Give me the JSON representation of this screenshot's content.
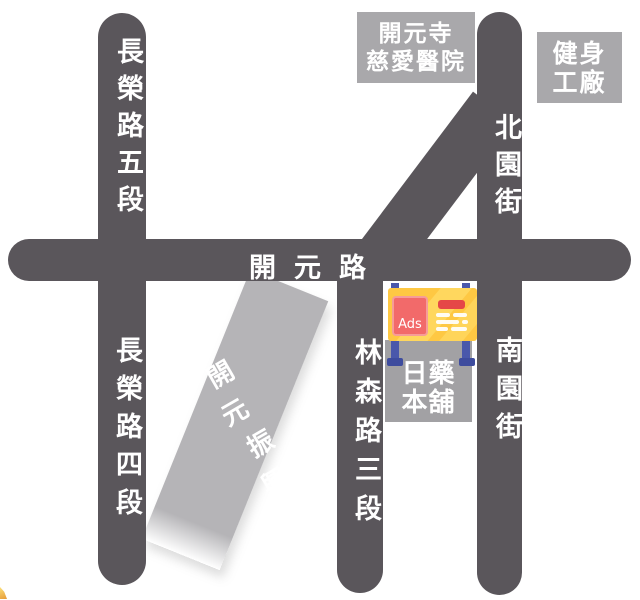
{
  "roads": {
    "changrong_5": "長榮路五段",
    "changrong_4": "長榮路四段",
    "kaiyuan": "開元路",
    "linsen_3": "林森路三段",
    "beiyuan": "北園街",
    "nanyuan": "南園街"
  },
  "park": {
    "line1": "開元",
    "line2": "振興",
    "line3": "公園"
  },
  "places": {
    "hospital": {
      "line1": "開元寺",
      "line2": "慈愛醫院"
    },
    "gym": {
      "line1": "健身",
      "line2": "工廠"
    },
    "drugstore": {
      "line1": "日藥",
      "line2": "本舖"
    }
  },
  "billboard": {
    "label": "Ads"
  },
  "colors": {
    "road": "#5a565b",
    "park": "#b5b4b7",
    "box_gray": "#a9a8ab",
    "box_gray2": "#a2a1a4",
    "sign_yellow": "#fec843",
    "sign_stripe": "#ffd75e",
    "ads_red": "#f26a6a",
    "ads_border": "#f69c98",
    "bar_red": "#e54747",
    "post_blue": "#4a58ab",
    "foot_blue": "#3e4c9e",
    "label_text": "#ffffff"
  }
}
